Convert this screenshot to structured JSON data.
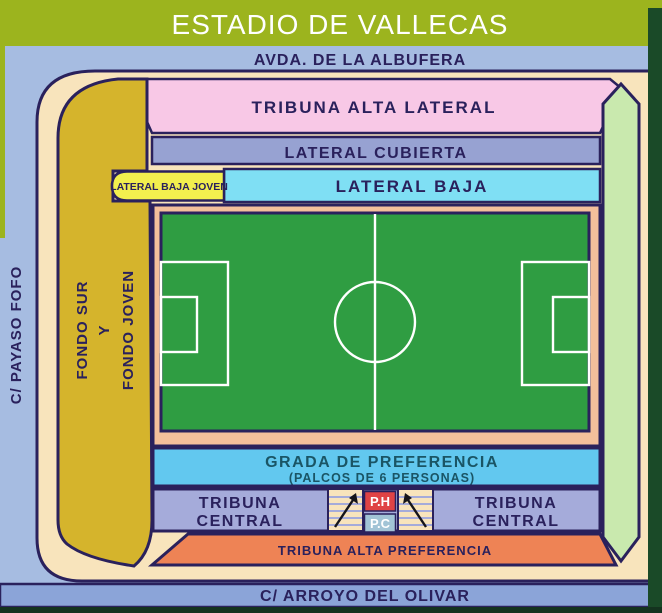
{
  "header": {
    "title": "ESTADIO DE VALLECAS"
  },
  "streets": {
    "top": "AVDA. DE LA ALBUFERA",
    "left": "C/ PAYASO FOFO",
    "bottom": "C/ ARROYO DEL OLIVAR"
  },
  "stands": {
    "tribuna_alta_lateral": "TRIBUNA ALTA LATERAL",
    "lateral_cubierta": "LATERAL CUBIERTA",
    "lateral_baja": "LATERAL BAJA",
    "lateral_baja_joven": "LATERAL BAJA JOVEN",
    "fondo": {
      "line1": "FONDO SUR",
      "line2": "Y",
      "line3": "FONDO JOVEN"
    },
    "grada_preferencia": {
      "line1": "GRADA DE PREFERENCIA",
      "line2": "(PALCOS DE 6 PERSONAS)"
    },
    "tribuna_central": {
      "line1": "TRIBUNA",
      "line2": "CENTRAL"
    },
    "palcos": {
      "ph": "P.H",
      "pc": "P.C"
    },
    "tribuna_alta_preferencia": "TRIBUNA ALTA PREFERENCIA"
  },
  "colors": {
    "title_bar": "#9CB41E",
    "map_background": "#A6BCE1",
    "concourse_cream": "#F8E4BC",
    "outline_navy": "#2A215C",
    "tribuna_alta_lateral_pink": "#F8C8E6",
    "lateral_cubierta_periwinkle": "#97A2D2",
    "lateral_baja_cyan": "#7FDFF4",
    "joven_label_yellow": "#F2EF4E",
    "fondo_sur_gold": "#D5B42C",
    "pitch_green": "#2F9D42",
    "pitch_surround_salmon": "#F3BF9B",
    "grada_blue": "#62C8EF",
    "tribuna_central_periwinkle": "#A5ABDA",
    "ph_red": "#DF4345",
    "pc_slate": "#A2C4D6",
    "tribuna_alta_preferencia_orange": "#EE8355",
    "fondo_norte_light_green": "#C9E9AE",
    "edge_dark_green": "#1A4A28",
    "bottom_street_band": "#8BA4D8"
  }
}
